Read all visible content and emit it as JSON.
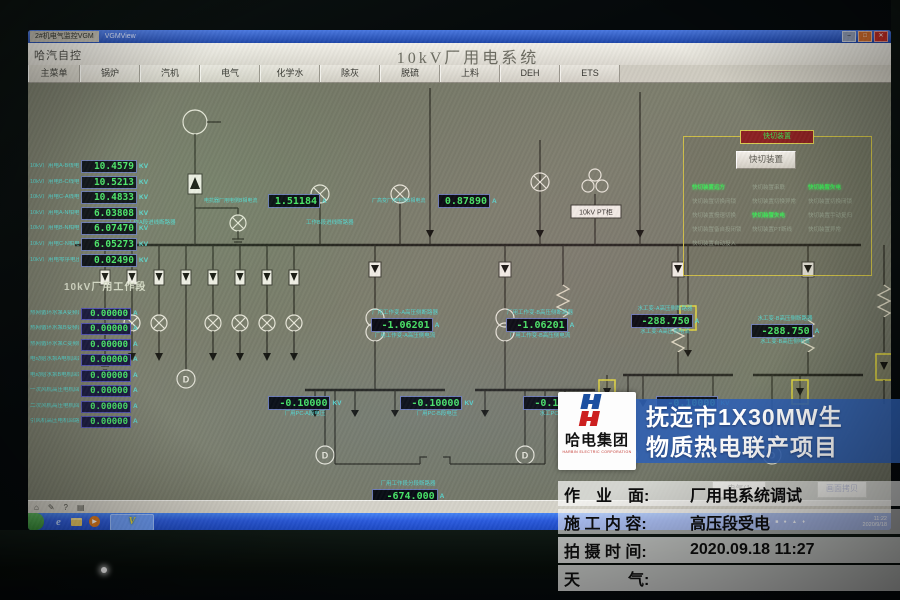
{
  "window": {
    "tab_title": "2#机电气监控VGM",
    "app_name": "VGMView",
    "min": "–",
    "max": "□",
    "close": "✕"
  },
  "header": {
    "brand": "哈汽自控",
    "title": "10kV厂用电系统"
  },
  "menu": {
    "items": [
      "主菜单",
      "锅炉",
      "汽机",
      "电气",
      "化学水",
      "除灰",
      "脱硫",
      "上料",
      "DEH",
      "ETS"
    ]
  },
  "mimic": {
    "bus_label": "10kV厂用工作段",
    "pt_box_label": "10kV PT柜",
    "motor_letter": "D",
    "incoming_a_label": "工作A段进线断路器",
    "incoming_b_label": "工作B段进线断路器",
    "voltages": {
      "unit": "KV",
      "rows": [
        {
          "label": "10kV厂用电A-B线电压",
          "value": "10.4579"
        },
        {
          "label": "10kV厂用电B-C线电压",
          "value": "10.5213"
        },
        {
          "label": "10kV厂用电C-A线电压",
          "value": "10.4833"
        },
        {
          "label": "10kV厂用电A-N相电压",
          "value": "6.03808"
        },
        {
          "label": "10kV厂用电B-N相电压",
          "value": "6.07470"
        },
        {
          "label": "10kV厂用电C-N相电压",
          "value": "6.05273"
        },
        {
          "label": "10kV厂用电零序电压",
          "value": "0.02490"
        }
      ]
    },
    "loads": {
      "unit": "A",
      "rows": [
        {
          "label": "热网循环水泵A变频回路电流",
          "value": "0.00000"
        },
        {
          "label": "热网循环水泵B变频回路电流",
          "value": "0.00000"
        },
        {
          "label": "热网循环水泵C变频回路电流",
          "value": "0.00000"
        },
        {
          "label": "电动给水泵A电机回路电流",
          "value": "0.00000"
        },
        {
          "label": "电动给水泵B电机回路电流",
          "value": "0.00000"
        },
        {
          "label": "一次风机高压电机回路电流",
          "value": "0.00000"
        },
        {
          "label": "二次风机高压电机回路电流",
          "value": "0.00000"
        },
        {
          "label": "引风机高压电机回路电流",
          "value": "0.00000"
        }
      ]
    },
    "reactor_current": {
      "label": "电抗器厂用电侧B相电流",
      "value": "1.51184",
      "unit": "A"
    },
    "standby_current": {
      "label": "厂高变厂用电侧B相电流",
      "value": "0.87890",
      "unit": "A"
    },
    "tx_a": {
      "above": "厂用工作变-A高压侧断路器",
      "value": "-1.06201",
      "unit": "A",
      "below": "厂用工作变-A高压侧电流"
    },
    "tx_b": {
      "above": "厂用工作变-B高压侧断路器",
      "value": "-1.06201",
      "unit": "A",
      "below": "厂用工作变-B高压侧电流"
    },
    "sg_a": {
      "above": "水工变-A高压侧断路器",
      "value": "-288.750",
      "unit": "A",
      "below": "水工变-A高压侧电流"
    },
    "sg_b": {
      "above": "水工变-B高压侧断路器",
      "value": "-288.750",
      "unit": "A",
      "below": "水工变-B高压侧电流"
    },
    "pc_a": {
      "value": "-0.10000",
      "unit": "KV",
      "below": "厂用PC-A段电压"
    },
    "pc_b": {
      "value": "-0.10000",
      "unit": "KV",
      "below": "厂用PC-B段电压"
    },
    "sgpc_a": {
      "value": "-0.10000",
      "unit": "KV",
      "below": "水工PC-A段电压"
    },
    "sgpc_b": {
      "value": "-0.10000",
      "unit": "KV",
      "below": "水工PC-B段电压"
    },
    "tie": {
      "above": "厂用工作段分段断路器",
      "value": "-674.000",
      "unit": "A",
      "below": "厂用工作段分段电流"
    }
  },
  "fast_switch": {
    "title": "快切装置",
    "button": "快切装置",
    "col1": [
      "快切装置远方",
      "快切装置切换闭锁",
      "快切装置慢速切换",
      "快切装置备自投闭锁",
      "快切装置自动投入"
    ],
    "col2": [
      "快切装置串联",
      "快切装置切换异常",
      "快切装置失电",
      "快切装置PT断线"
    ],
    "col3": [
      "快切装置失电",
      "快切装置切换闭锁",
      "快切装置手动复归",
      "快切装置异常"
    ]
  },
  "toolbar": {
    "icon1": "⌂",
    "icon2": "✎",
    "icon3": "?",
    "icon4": "▤"
  },
  "hmi_buttons": {
    "b1": "电气(1",
    "b2": "画面拷贝"
  },
  "taskbar": {
    "quick_e": "e",
    "media_glyph": "▶",
    "app_btn": "V",
    "tray_icons": "◆ ■ ● ▲ ♦",
    "time": "11:22",
    "date": "2020/9/18"
  },
  "overlay": {
    "brand": "哈电集团",
    "brand_sub": "HARBIN ELECTRIC CORPORATION",
    "project_line1": "抚远市1X30MW生",
    "project_line2": "物质热电联产项目",
    "rows": [
      {
        "label": "作　业　面:",
        "value": "厂用电系统调试"
      },
      {
        "label": "施 工 内 容:",
        "value": "高压段受电"
      },
      {
        "label": "拍 摄 时 间:",
        "value": "2020.09.18 11:27"
      },
      {
        "label": "天　　　气:",
        "value": ""
      }
    ]
  },
  "colors": {
    "accent_green": "#46e564",
    "label_cyan": "#52d8d0",
    "panel_yellow": "#cdbf45",
    "xp_blue": "#2a5ade",
    "band_blue": "#2e60b4"
  }
}
